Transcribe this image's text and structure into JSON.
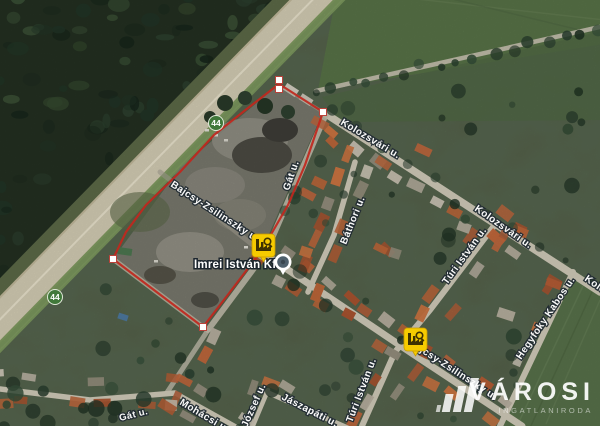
{
  "street_labels": {
    "kolozsvari_1": "Kolozsvári u.",
    "kolozsvari_2": "Kolozsvári u.",
    "kolozsvari_3": "Kolozsvári u.",
    "gat_1": "Gát u.",
    "gat_2": "Gát u.",
    "bathori": "Báthori u.",
    "bajcsy_1": "Bajcsy-Zsilinszky u.",
    "bajcsy_2": "Bajcsy-Zsilinszky u.",
    "turi_1": "Túri István u.",
    "turi_2": "Túri István u.",
    "hegyfoky": "Hegyfoky Kabos u.",
    "jaszapati": "Jászapáti u.",
    "mohacsi": "Mohácsi u.",
    "jozsef": "József u."
  },
  "poi": {
    "name": "Imrei István Kft"
  },
  "route": {
    "number": "44"
  },
  "icons": {
    "factory_marker": "factory",
    "poi_pin": "circle-pin"
  },
  "colors": {
    "boundary": "#c1271d",
    "marker_yellow": "#f6cb00",
    "badge_green": "#40783a",
    "pin_inner": "#4e5f6b"
  },
  "watermark": {
    "brand": "VÁROSI",
    "tagline": "INGATLANIRODA"
  }
}
